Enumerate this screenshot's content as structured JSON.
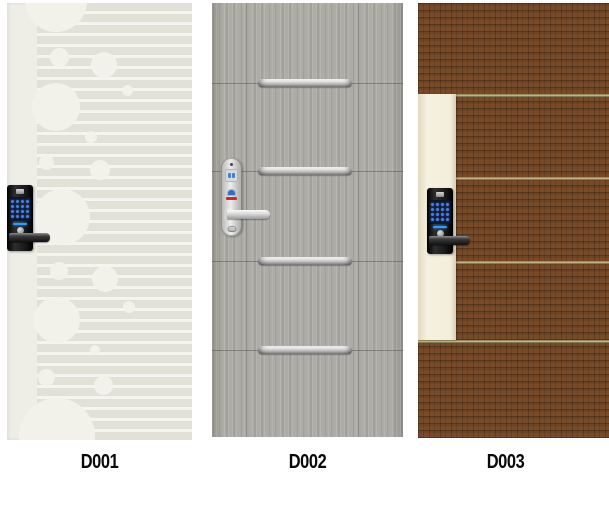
{
  "catalog": {
    "items": [
      {
        "label": "D001",
        "door_finish": "cream-circles-and-stripes-pattern",
        "lock_style": "black-keypad-lock",
        "door_color": "#efeee6",
        "pattern_color": "#e2e1d7",
        "keypad_color": "#4d7fdd"
      },
      {
        "label": "D002",
        "door_finish": "gray-woodgrain-with-steel-bars",
        "lock_style": "silver-lever-lock",
        "door_color": "#aeaca6",
        "bar_color": "#c9c9c9",
        "emblem_colors": [
          "#3a6cc0",
          "#cf2a2a"
        ]
      },
      {
        "label": "D003",
        "door_finish": "brown-woven-panels-with-ivory-stile",
        "lock_style": "black-keypad-lock",
        "door_color": "#6d4424",
        "stile_color": "#f3eeda",
        "divider_color": "#cfc492"
      }
    ]
  }
}
